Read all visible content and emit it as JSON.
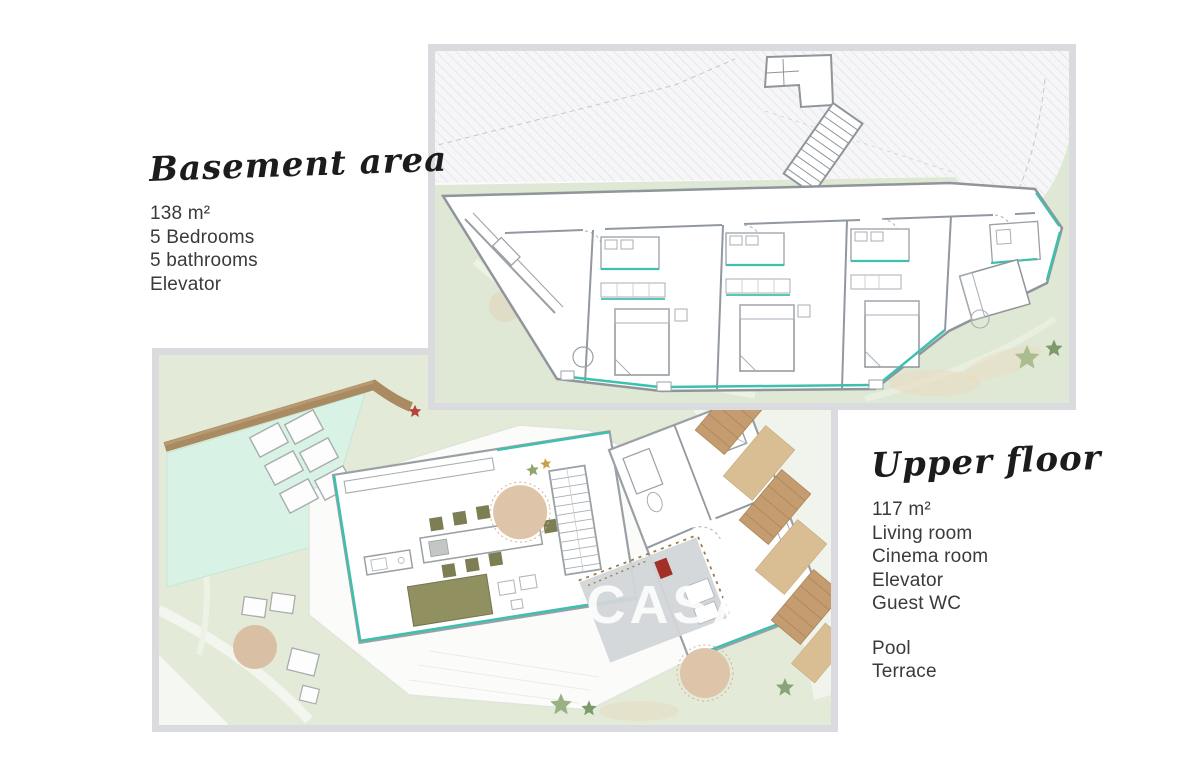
{
  "basement_panel": {
    "title": "Basement area",
    "area": "138 m²",
    "features": [
      "5 Bedrooms",
      "5 bathrooms",
      "Elevator"
    ]
  },
  "upper_panel": {
    "title": "Upper floor",
    "area": "117 m²",
    "features": [
      "Living room",
      "Cinema room",
      "Elevator",
      "Guest WC"
    ],
    "outdoor_features": [
      "Pool",
      "Terrace"
    ]
  },
  "watermark": "CASA",
  "colors": {
    "card_border": "#d9dbdf",
    "accent_teal": "#3fbfae",
    "landscape_green": "#dfe8d4",
    "pool_mint": "#d9f2e6",
    "wood_brown": "#c59c6f",
    "cinema_gray": "#d2d6d8",
    "cinema_red": "#a23026",
    "tree_beige": "#dec5a9"
  }
}
